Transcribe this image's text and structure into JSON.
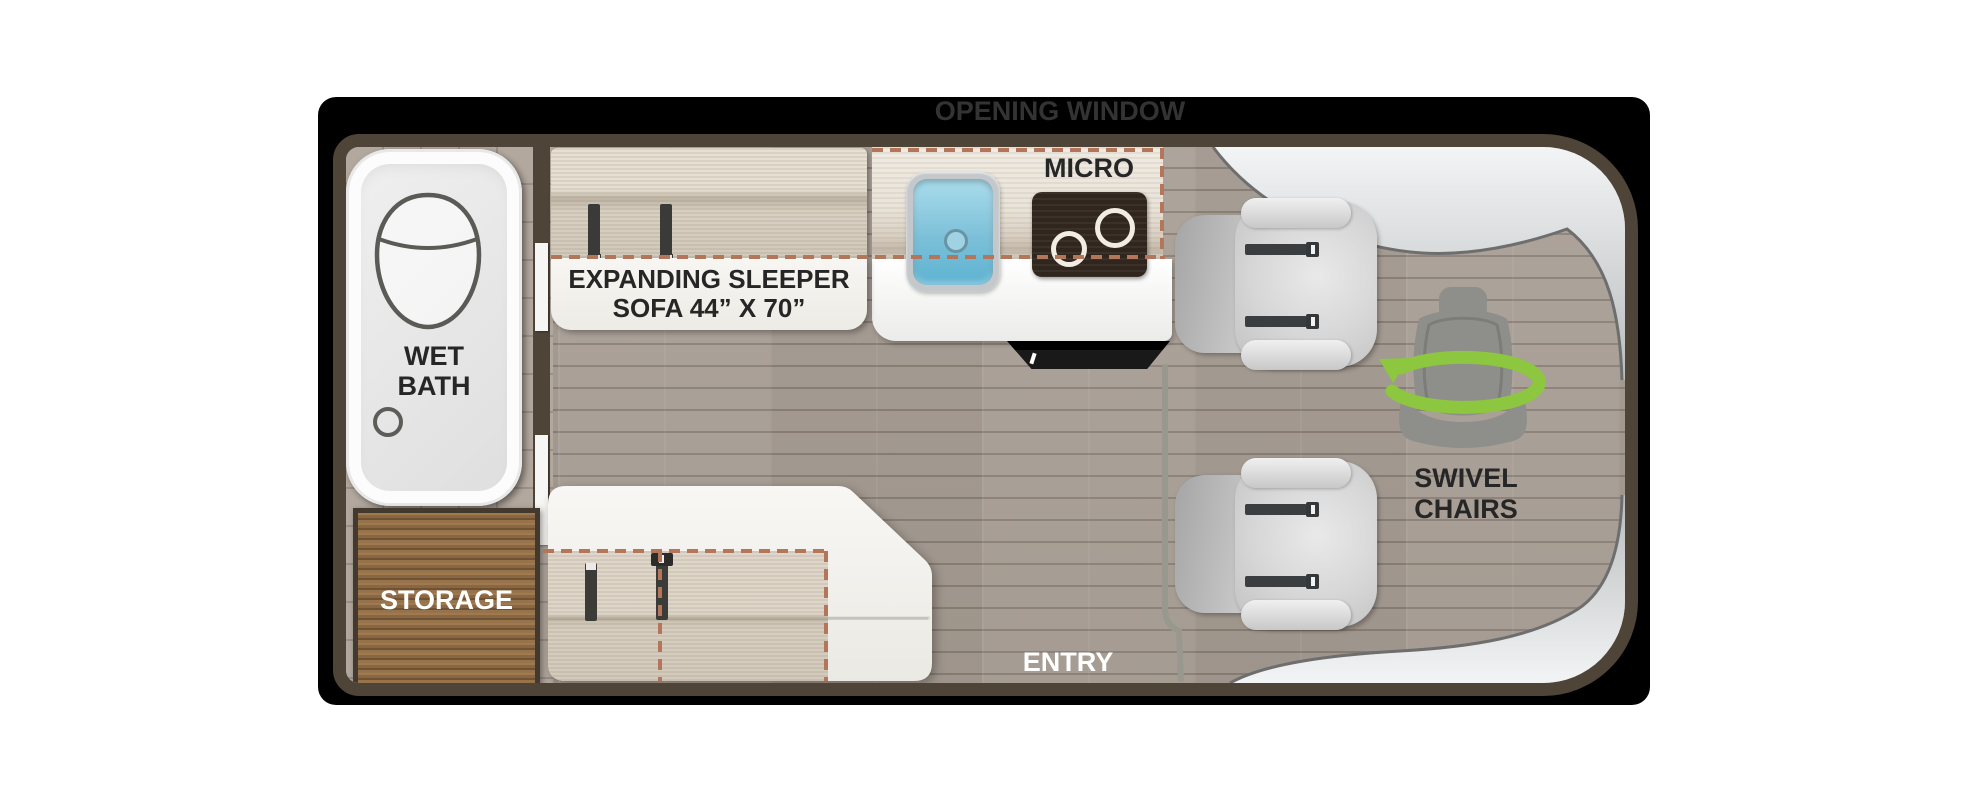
{
  "labels": {
    "opening_window": "OPENING WINDOW",
    "micro": "MICRO",
    "wet_bath_1": "WET",
    "wet_bath_2": "BATH",
    "sleeper_1": "EXPANDING SLEEPER",
    "sleeper_2": "SOFA  44” X 70”",
    "storage": "STORAGE",
    "entry": "ENTRY",
    "swivel_1": "SWIVEL",
    "swivel_2": "CHAIRS"
  },
  "colors": {
    "wall": "#4f4438",
    "floor": "#a69d94",
    "counter": "#e9e3d9",
    "fabric": "#d9d1c4",
    "storage_wood": "#8f6c46",
    "sink_blue": "#7cc0d8",
    "stove": "#30261d",
    "dash": "#b3765a",
    "accent_green": "#8dc63f",
    "cab_silver": "#d7dadc"
  },
  "icons": [
    "toilet-icon",
    "flush-button-icon",
    "sink-icon",
    "stove-icon",
    "tv-icon",
    "seatbelt-icon",
    "swivel-seat-icon",
    "rotation-arrow-icon",
    "opening-window-strip",
    "entry-door-strip"
  ]
}
